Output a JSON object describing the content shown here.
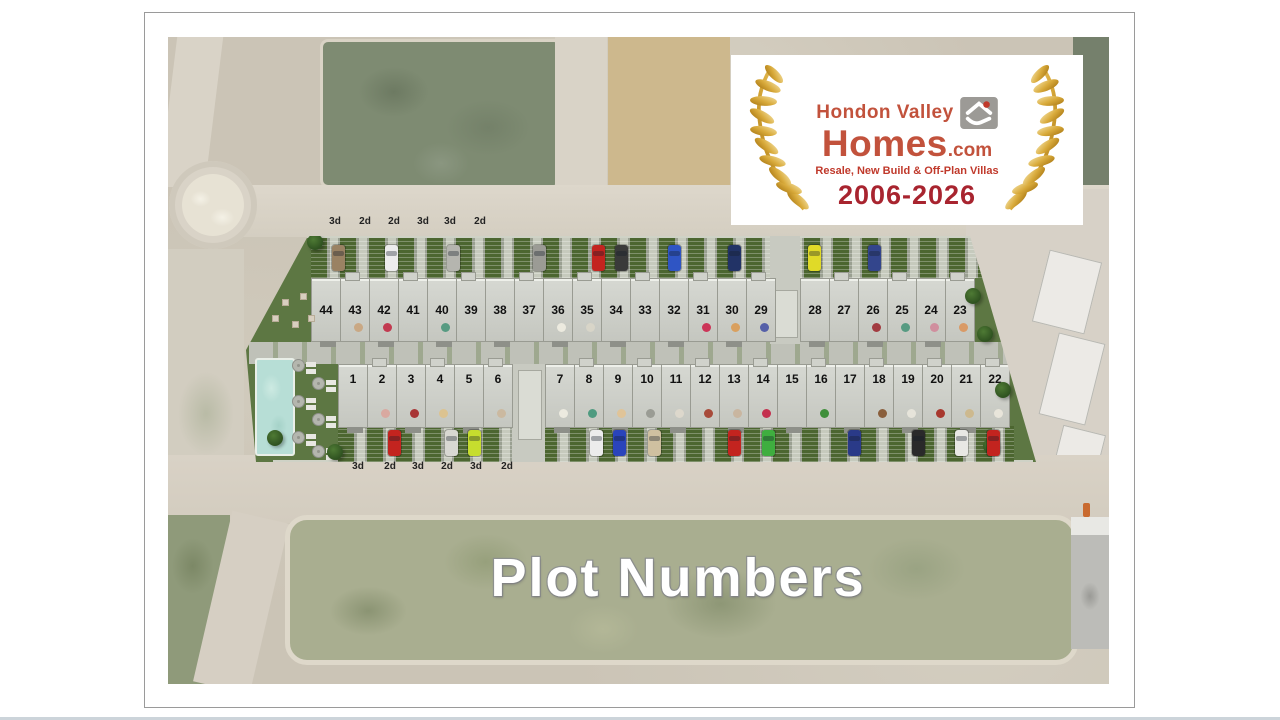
{
  "overlay": {
    "title": "Plot Numbers"
  },
  "logo": {
    "brand_line1": "Hondon Valley",
    "brand_line2": "Homes",
    "brand_suffix": ".com",
    "tagline": "Resale, New Build & Off-Plan Villas",
    "years": "2006-2026",
    "icon": "house-hand-icon",
    "colors": {
      "brand_red": "#c2523c",
      "tagline_red": "#c0392b",
      "years_red": "#a8242f",
      "gold": "#d9ab3c"
    }
  },
  "site": {
    "colors": {
      "lawn_green": "#5d7743",
      "pool_aqua": "#b7ded6",
      "road_gray": "#d8d2c6"
    },
    "labels_top": [
      {
        "text": "3d",
        "x": 167
      },
      {
        "text": "2d",
        "x": 197
      },
      {
        "text": "2d",
        "x": 226
      },
      {
        "text": "3d",
        "x": 255
      },
      {
        "text": "3d",
        "x": 282
      },
      {
        "text": "2d",
        "x": 312
      }
    ],
    "labels_bottom": [
      {
        "text": "3d",
        "x": 190
      },
      {
        "text": "2d",
        "x": 222
      },
      {
        "text": "3d",
        "x": 250
      },
      {
        "text": "2d",
        "x": 279
      },
      {
        "text": "3d",
        "x": 308
      },
      {
        "text": "2d",
        "x": 339
      }
    ],
    "plots_top_left": [
      {
        "n": "44",
        "dot": ""
      },
      {
        "n": "43",
        "dot": "#c9a884"
      },
      {
        "n": "42",
        "dot": "#c23a50"
      },
      {
        "n": "41",
        "dot": ""
      },
      {
        "n": "40",
        "dot": "#579b82"
      },
      {
        "n": "39",
        "dot": ""
      },
      {
        "n": "38",
        "dot": ""
      },
      {
        "n": "37",
        "dot": ""
      },
      {
        "n": "36",
        "dot": "#eceadf"
      },
      {
        "n": "35",
        "dot": "#d8d5c8"
      },
      {
        "n": "34",
        "dot": ""
      },
      {
        "n": "33",
        "dot": ""
      },
      {
        "n": "32",
        "dot": ""
      },
      {
        "n": "31",
        "dot": "#cc3558"
      },
      {
        "n": "30",
        "dot": "#d9a05f"
      },
      {
        "n": "29",
        "dot": "#5560a8"
      }
    ],
    "plots_top_right": [
      {
        "n": "28",
        "dot": ""
      },
      {
        "n": "27",
        "dot": ""
      },
      {
        "n": "26",
        "dot": "#a23b40"
      },
      {
        "n": "25",
        "dot": "#579b82"
      },
      {
        "n": "24",
        "dot": "#d08f9e"
      },
      {
        "n": "23",
        "dot": "#d99a66"
      }
    ],
    "plots_bottom_left": [
      {
        "n": "1",
        "dot": ""
      },
      {
        "n": "2",
        "dot": "#d9a9a0"
      },
      {
        "n": "3",
        "dot": "#a83535"
      },
      {
        "n": "4",
        "dot": "#dcc390"
      },
      {
        "n": "5",
        "dot": ""
      },
      {
        "n": "6",
        "dot": "#cbb9a0"
      }
    ],
    "plots_bottom_right": [
      {
        "n": "7",
        "dot": "#eceadf"
      },
      {
        "n": "8",
        "dot": "#4f9b80"
      },
      {
        "n": "9",
        "dot": "#e0c498"
      },
      {
        "n": "10",
        "dot": "#9a9c94"
      },
      {
        "n": "11",
        "dot": "#ddd8cc"
      },
      {
        "n": "12",
        "dot": "#a84b3a"
      },
      {
        "n": "13",
        "dot": "#c9b6a0"
      },
      {
        "n": "14",
        "dot": "#c4304e"
      },
      {
        "n": "15",
        "dot": ""
      },
      {
        "n": "16",
        "dot": "#3f8f3a"
      },
      {
        "n": "17",
        "dot": ""
      },
      {
        "n": "18",
        "dot": "#8a5f3c"
      },
      {
        "n": "19",
        "dot": "#e6e4da"
      },
      {
        "n": "20",
        "dot": "#a8382e"
      },
      {
        "n": "21",
        "dot": "#cdb98e"
      },
      {
        "n": "22",
        "dot": "#e8e5da"
      }
    ],
    "cars_top": [
      {
        "x": 89,
        "c": "#9a8263"
      },
      {
        "x": 142,
        "c": "#ececec"
      },
      {
        "x": 204,
        "c": "#b5b5af"
      },
      {
        "x": 290,
        "c": "#9b9b95"
      },
      {
        "x": 349,
        "c": "#c3241f"
      },
      {
        "x": 372,
        "c": "#3a3a3a"
      },
      {
        "x": 425,
        "c": "#2f55c4"
      },
      {
        "x": 485,
        "c": "#223366"
      },
      {
        "x": 565,
        "c": "#e0da28"
      },
      {
        "x": 625,
        "c": "#33458c"
      }
    ],
    "cars_bottom": [
      {
        "x": 145,
        "c": "#c3241f"
      },
      {
        "x": 202,
        "c": "#d8d8d2"
      },
      {
        "x": 225,
        "c": "#c6dd2e"
      },
      {
        "x": 347,
        "c": "#ececec"
      },
      {
        "x": 370,
        "c": "#2a44bb"
      },
      {
        "x": 405,
        "c": "#cfc0a0"
      },
      {
        "x": 485,
        "c": "#c3241f"
      },
      {
        "x": 519,
        "c": "#3fae3f"
      },
      {
        "x": 605,
        "c": "#2a3a88"
      },
      {
        "x": 669,
        "c": "#2a2a2a"
      },
      {
        "x": 712,
        "c": "#e8e8e4"
      },
      {
        "x": 744,
        "c": "#c3241f"
      }
    ],
    "parasols": [
      {
        "x": 50,
        "y": 128
      },
      {
        "x": 70,
        "y": 146
      },
      {
        "x": 50,
        "y": 164
      },
      {
        "x": 70,
        "y": 182
      },
      {
        "x": 50,
        "y": 200
      },
      {
        "x": 70,
        "y": 214
      }
    ],
    "furniture": [
      {
        "x": 24,
        "y": 60
      },
      {
        "x": 40,
        "y": 68
      },
      {
        "x": 58,
        "y": 62
      },
      {
        "x": 30,
        "y": 84
      },
      {
        "x": 50,
        "y": 90
      },
      {
        "x": 66,
        "y": 84
      }
    ],
    "trees": [
      {
        "x": 8,
        "y": 44
      },
      {
        "x": 64,
        "y": 2
      },
      {
        "x": 722,
        "y": 56
      },
      {
        "x": 734,
        "y": 94
      },
      {
        "x": 740,
        "y": 206
      },
      {
        "x": 84,
        "y": 212
      },
      {
        "x": 24,
        "y": 198
      },
      {
        "x": 752,
        "y": 150
      }
    ]
  }
}
